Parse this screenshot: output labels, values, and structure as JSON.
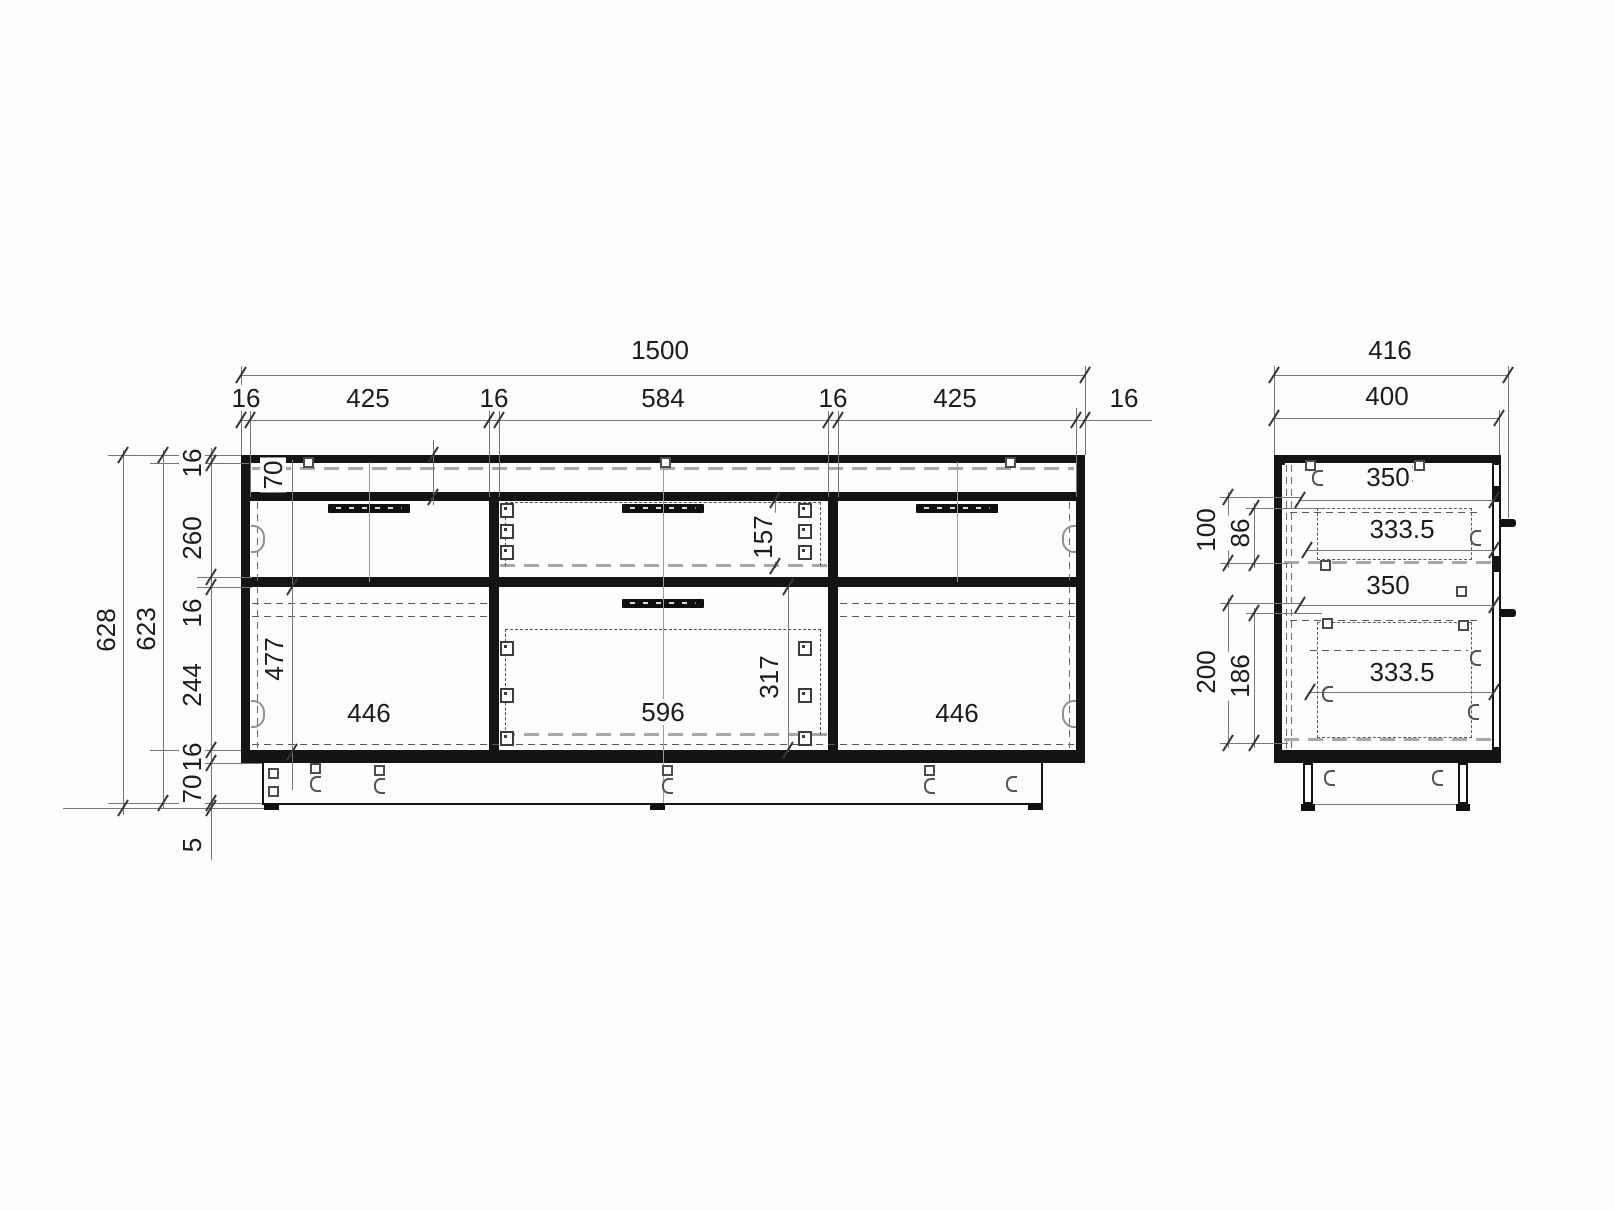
{
  "front_view": {
    "dim_width_total": "1500",
    "dim_widths": [
      "16",
      "425",
      "16",
      "584",
      "16",
      "425",
      "16"
    ],
    "dim_height_total": "628",
    "dim_height_inner": "623",
    "dim_heights": [
      "16",
      "260",
      "16",
      "244",
      "16",
      "70",
      "5"
    ],
    "labels": {
      "top_rail_height": "70",
      "mid_drawer_height": "157",
      "door_height": "477",
      "left_door_width": "446",
      "big_drawer_width": "596",
      "big_drawer_height": "317",
      "right_door_width": "446"
    }
  },
  "side_view": {
    "dim_depth_total": "416",
    "dim_depth_body": "400",
    "dim_upper_offset": "100",
    "dim_upper_inner": "86",
    "dim_lower_offset": "200",
    "dim_lower_inner": "186",
    "labels": {
      "top_shelf_depth": "350",
      "upper_drawer_depth": "333.5",
      "mid_shelf_depth": "350",
      "lower_drawer_depth": "333.5"
    }
  }
}
